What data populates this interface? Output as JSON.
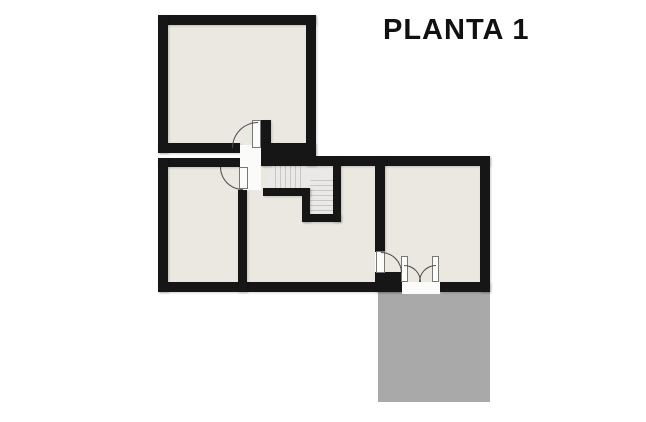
{
  "title": "PLANTA 1",
  "floorplan": {
    "floor_label": "PLANTA 1",
    "elements": {
      "rooms": [
        "room-top-left",
        "room-bottom-left",
        "room-middle",
        "room-right"
      ],
      "features": [
        "staircase-l-shaped",
        "terrace",
        "door-top-room",
        "door-bottom-left-room",
        "door-right-room",
        "double-door-terrace"
      ]
    },
    "colors": {
      "background": "#FFFFFF",
      "wall": "#161616",
      "room_fill": "#EBE8E2",
      "stair_fill": "#EAE9E7",
      "stair_line": "#C8C7C5",
      "terrace_fill": "#A9A9A9",
      "threshold": "#FBFBF9",
      "door_leaf": "#FCFCFA",
      "door_arc": "#4A4A4A",
      "title_color": "#111111"
    }
  }
}
